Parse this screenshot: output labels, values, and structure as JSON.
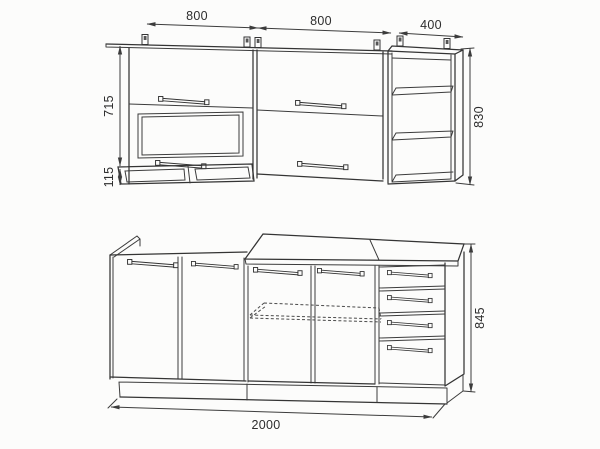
{
  "canvas": {
    "width": 600,
    "height": 449,
    "background": "#fcfcfb",
    "line_color": "#343434"
  },
  "drawing": {
    "dimensions": {
      "wall_left_width": "800",
      "wall_center_width": "800",
      "wall_right_width": "400",
      "wall_door_height": "715",
      "wall_niche_height": "115",
      "wall_total_height": "830",
      "base_total_width": "2000",
      "base_total_height": "845"
    }
  }
}
